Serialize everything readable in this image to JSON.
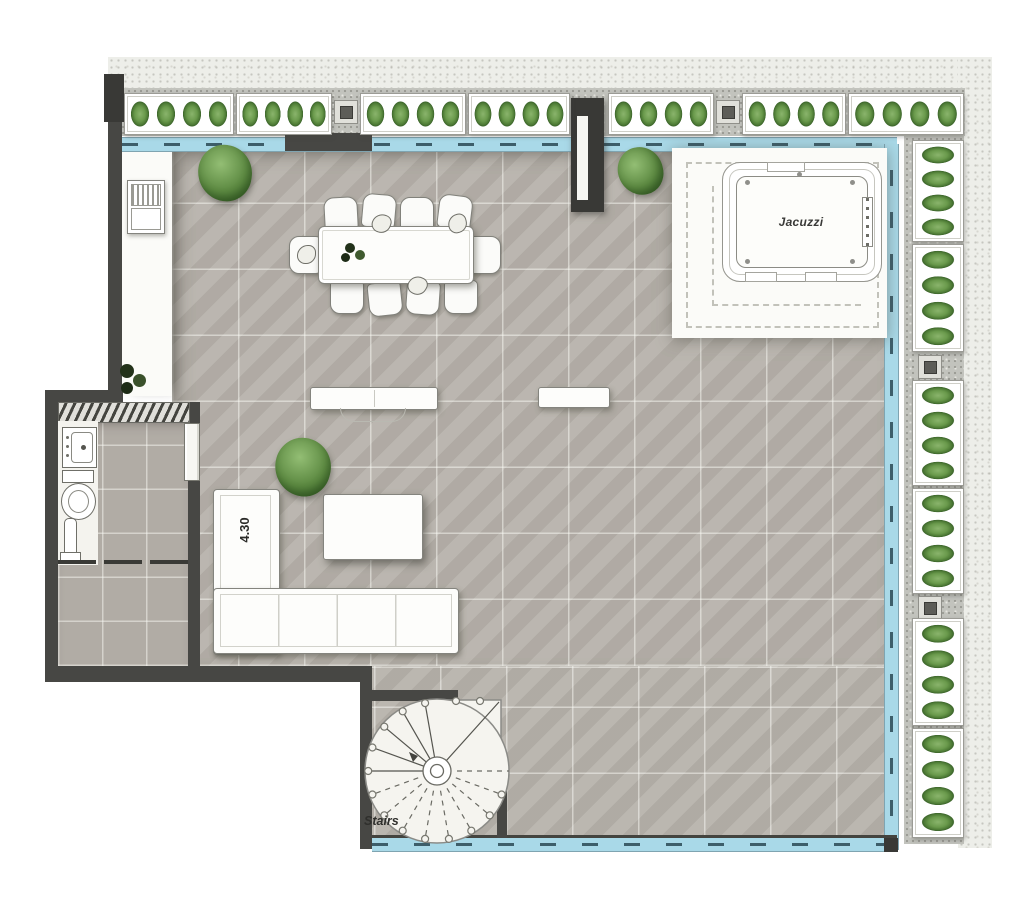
{
  "document": {
    "type": "architectural floor plan",
    "view": "top-down roof terrace / penthouse level"
  },
  "labels": {
    "jacuzzi": "Jacuzzi",
    "sofa_dimension": "4.30",
    "stairs": "Stairs"
  },
  "legend_colors": {
    "wall_dark": "#474744",
    "terrace_tile": "#b6b1aa",
    "tile_grout": "#faf9f5",
    "glass_railing_blue": "#a9d9e8",
    "railing_dash": "#3d5e6a",
    "planter_green": "#5d8a42",
    "furniture_white": "#fdfdfb",
    "jacuzzi_deck_white": "#fbfbf8",
    "outer_band": "#edeee9"
  },
  "inventory": {
    "top_planter_boxes": 7,
    "right_planter_boxes": 6,
    "bushes_per_planter_box": 4,
    "railing_posts": 4,
    "dining_chairs": 10,
    "dining_table": 1,
    "l_shaped_sofa": 1,
    "coffee_table": 1,
    "benches": 2,
    "jacuzzi": 1,
    "jacuzzi_deck_dashed_border": true,
    "spiral_staircase": 1,
    "bathroom_fixtures": [
      "sink",
      "toilet",
      "shower"
    ],
    "standalone_bushes": 3,
    "bbq_grill_unit": 1,
    "column_pillar": 1
  }
}
